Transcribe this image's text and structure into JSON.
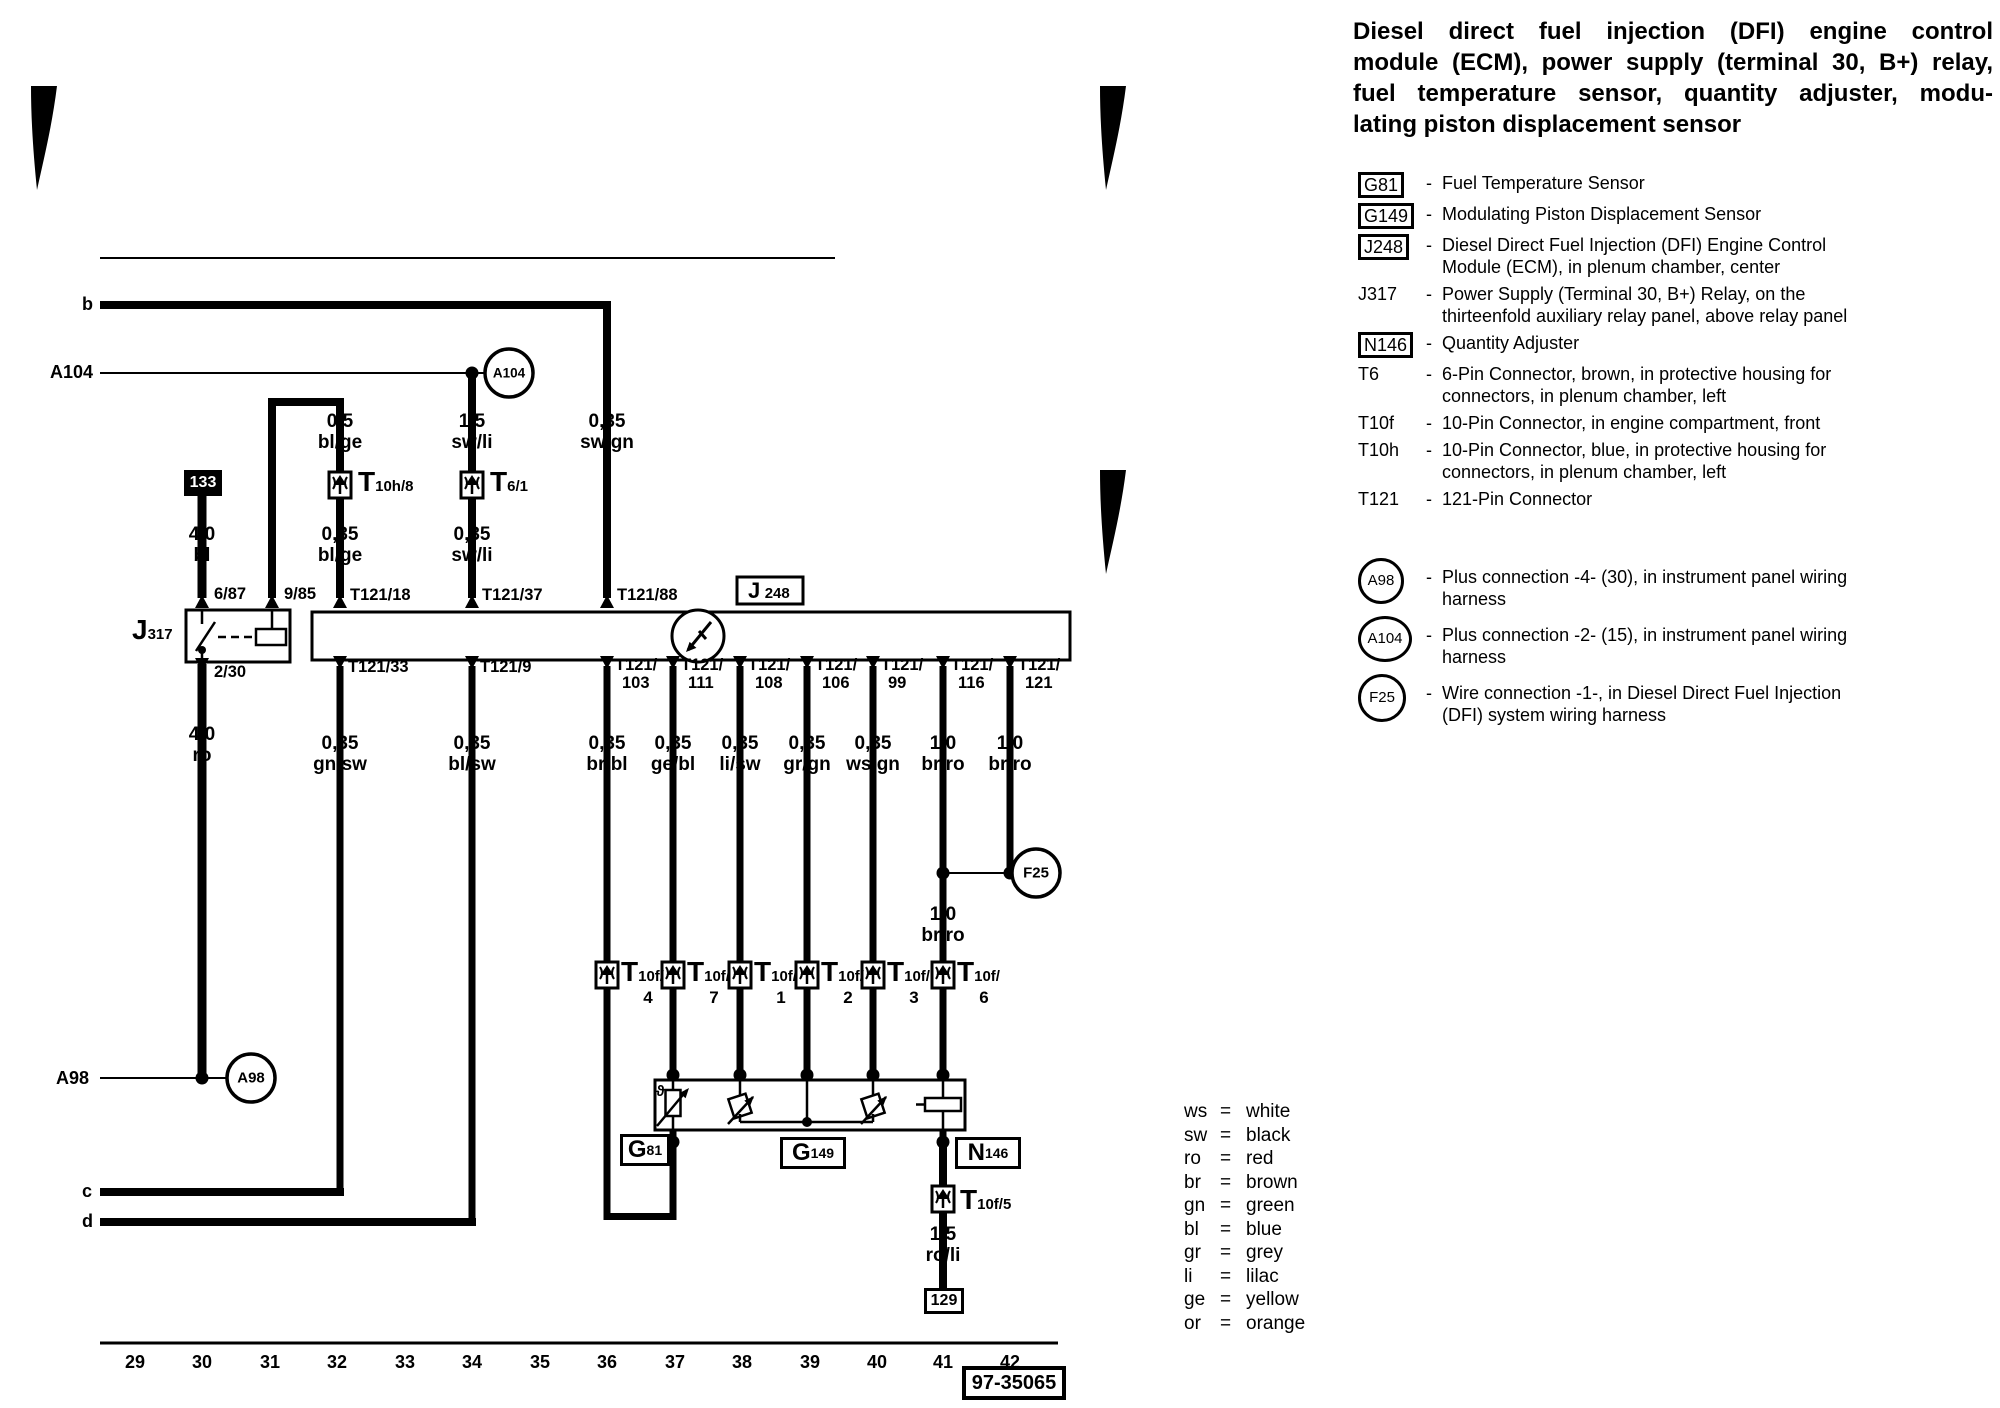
{
  "title_lines": [
    "Diesel direct fuel injection (DFI) engine control",
    "module (ECM), power supply (terminal 30, B+) relay,",
    "fuel temperature sensor, quantity adjuster, modu-",
    "lating piston displacement sensor"
  ],
  "legend": {
    "dash": "-",
    "rows": [
      {
        "code": "G81",
        "style": "box",
        "desc": "Fuel Temperature Sensor"
      },
      {
        "code": "G149",
        "style": "box",
        "desc": "Modulating Piston Displacement Sensor"
      },
      {
        "code": "J248",
        "style": "box",
        "desc": "Diesel Direct Fuel Injection (DFI) Engine Control Module (ECM), in plenum chamber, center"
      },
      {
        "code": "J317",
        "style": "plain",
        "desc": "Power Supply (Terminal 30, B+) Relay, on the thirteenfold auxiliary relay panel, above relay panel"
      },
      {
        "code": "N146",
        "style": "box",
        "desc": "Quantity Adjuster"
      },
      {
        "code": "T6",
        "style": "plain",
        "desc": "6-Pin Connector, brown, in protective housing for connectors, in plenum chamber, left"
      },
      {
        "code": "T10f",
        "style": "plain",
        "desc": "10-Pin Connector, in engine compartment, front"
      },
      {
        "code": "T10h",
        "style": "plain",
        "desc": "10-Pin Connector, blue, in protective housing for connectors, in plenum chamber, left"
      },
      {
        "code": "T121",
        "style": "plain",
        "desc": "121-Pin Connector"
      }
    ],
    "connections": [
      {
        "code": "A98",
        "desc": "Plus connection -4- (30), in instrument panel wiring harness"
      },
      {
        "code": "A104",
        "desc": "Plus connection -2- (15), in instrument panel wiring harness"
      },
      {
        "code": "F25",
        "desc": "Wire connection -1-, in Diesel Direct Fuel Injection (DFI) system wiring harness"
      }
    ]
  },
  "color_eq": "=",
  "color_key": [
    {
      "abbr": "ws",
      "name": "white"
    },
    {
      "abbr": "sw",
      "name": "black"
    },
    {
      "abbr": "ro",
      "name": "red"
    },
    {
      "abbr": "br",
      "name": "brown"
    },
    {
      "abbr": "gn",
      "name": "green"
    },
    {
      "abbr": "bl",
      "name": "blue"
    },
    {
      "abbr": "gr",
      "name": "grey"
    },
    {
      "abbr": "li",
      "name": "lilac"
    },
    {
      "abbr": "ge",
      "name": "yellow"
    },
    {
      "abbr": "or",
      "name": "orange"
    }
  ],
  "diagram": {
    "page_code": "97-35065",
    "tracks": [
      "29",
      "30",
      "31",
      "32",
      "33",
      "34",
      "35",
      "36",
      "37",
      "38",
      "39",
      "40",
      "41",
      "42"
    ],
    "rails": {
      "b": "b",
      "c": "c",
      "d": "d",
      "a104": "A104",
      "a98": "A98"
    },
    "nodes": {
      "a104": "A104",
      "a98": "A98",
      "f25": "F25",
      "t133": "133",
      "t129": "129"
    },
    "relay": {
      "letter": "J",
      "num": "317",
      "pin1": "6/87",
      "pin2": "9/85",
      "pin3": "2/30"
    },
    "ecm": {
      "letter": "J",
      "num": "248"
    },
    "ecm_pins_top": [
      "T121/18",
      "T121/37",
      "T121/88"
    ],
    "ecm_pins_bottom": [
      {
        "l1": "T121/33",
        "l2": ""
      },
      {
        "l1": "T121/9",
        "l2": ""
      },
      {
        "l1": "T121/",
        "l2": "103"
      },
      {
        "l1": "T121/",
        "l2": "111"
      },
      {
        "l1": "T121/",
        "l2": "108"
      },
      {
        "l1": "T121/",
        "l2": "106"
      },
      {
        "l1": "T121/",
        "l2": "99"
      },
      {
        "l1": "T121/",
        "l2": "116"
      },
      {
        "l1": "T121/",
        "l2": "121"
      }
    ],
    "wire_labels": [
      {
        "size": "0,5",
        "color": "bl/ge"
      },
      {
        "size": "1,5",
        "color": "sw/li"
      },
      {
        "size": "0,35",
        "color": "sw/gn"
      },
      {
        "size": "4,0",
        "color": "bl"
      },
      {
        "size": "0,35",
        "color": "bl/ge"
      },
      {
        "size": "0,35",
        "color": "sw/li"
      },
      {
        "size": "4,0",
        "color": "ro"
      },
      {
        "size": "0,35",
        "color": "gn/sw"
      },
      {
        "size": "0,35",
        "color": "bl/sw"
      },
      {
        "size": "0,35",
        "color": "br/bl"
      },
      {
        "size": "0,35",
        "color": "ge/bl"
      },
      {
        "size": "0,35",
        "color": "li/sw"
      },
      {
        "size": "0,35",
        "color": "gr/gn"
      },
      {
        "size": "0,35",
        "color": "ws/gn"
      },
      {
        "size": "1,0",
        "color": "br/ro"
      },
      {
        "size": "1,0",
        "color": "br/ro"
      },
      {
        "size": "1,0",
        "color": "br/ro"
      },
      {
        "size": "1,5",
        "color": "ro/li"
      }
    ],
    "connectors": {
      "t10h8": {
        "letter": "T",
        "sub": "10h/8"
      },
      "t61": {
        "letter": "T",
        "sub": "6/1"
      },
      "t10f5": {
        "letter": "T",
        "sub": "10f/5"
      },
      "t10f_row": [
        {
          "letter": "T",
          "sub": "10f/",
          "num": "4"
        },
        {
          "letter": "T",
          "sub": "10f/",
          "num": "7"
        },
        {
          "letter": "T",
          "sub": "10f/",
          "num": "1"
        },
        {
          "letter": "T",
          "sub": "10f/",
          "num": "2"
        },
        {
          "letter": "T",
          "sub": "10f/",
          "num": "3"
        },
        {
          "letter": "T",
          "sub": "10f/",
          "num": "6"
        }
      ]
    },
    "components": {
      "g81": {
        "letter": "G",
        "num": "81"
      },
      "g149": {
        "letter": "G",
        "num": "149"
      },
      "n146": {
        "letter": "N",
        "num": "146"
      },
      "theta": "ϑ"
    }
  }
}
